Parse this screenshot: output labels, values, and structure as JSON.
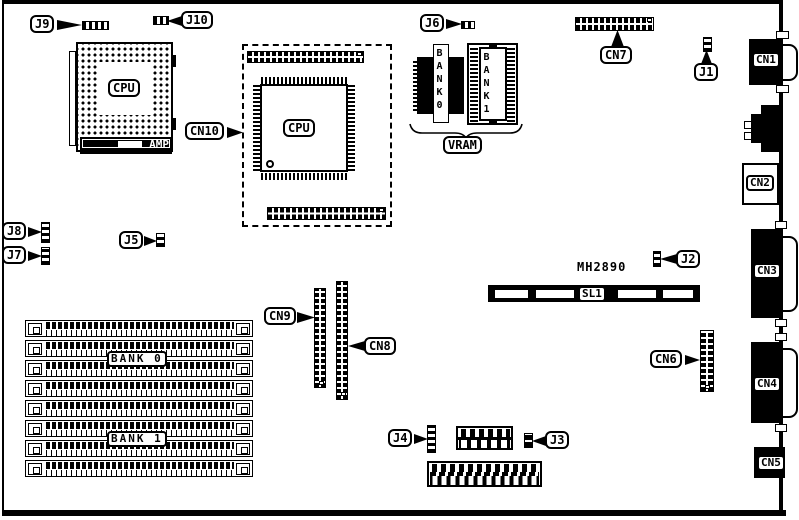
{
  "board": {
    "description": "motherboard component location diagram",
    "text": {
      "mh2890": "MH2890"
    },
    "chips": {
      "cpu_socket": "CPU",
      "cpu_qfp": "CPU",
      "amp": "AMP"
    },
    "jumpers": {
      "j1": "J1",
      "j2": "J2",
      "j3": "J3",
      "j4": "J4",
      "j5": "J5",
      "j6": "J6",
      "j7": "J7",
      "j8": "J8",
      "j9": "J9",
      "j10": "J10"
    },
    "connectors": {
      "cn1": "CN1",
      "cn2": "CN2",
      "cn3": "CN3",
      "cn4": "CN4",
      "cn5": "CN5",
      "cn6": "CN6",
      "cn7": "CN7",
      "cn8": "CN8",
      "cn9": "CN9",
      "cn10": "CN10",
      "sl1": "SL1"
    },
    "memory": {
      "simm_bank0": "BANK 0",
      "simm_bank1": "BANK 1",
      "vram": "VRAM",
      "vram_bank0": "BANK0",
      "vram_bank1": "BANK1"
    },
    "colors": {
      "ink": "#000000",
      "paper": "#ffffff"
    }
  }
}
